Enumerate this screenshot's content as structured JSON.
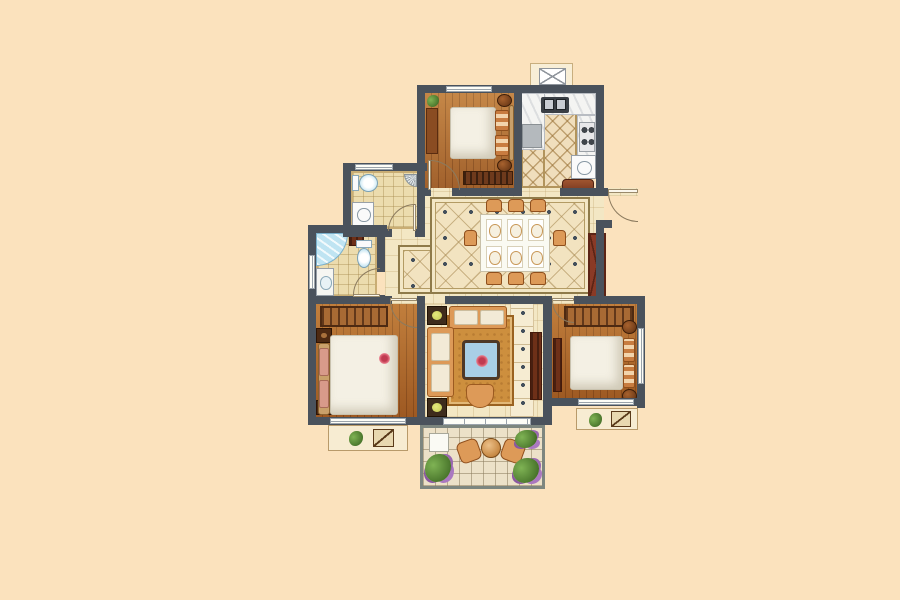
{
  "scene": {
    "type": "residential-floor-plan",
    "view": "top-down-rendered",
    "text_labels": []
  },
  "colors": {
    "bg": "#fbe2bd",
    "wall": "#4a525c",
    "wall_light": "#7d867f",
    "wood": "#b06a2c",
    "wood_light": "#b5753a",
    "tile": "#f3e7c4",
    "dining_tile": "#f2e3c0",
    "kitchen_tile": "#f0debc",
    "bath_tile": "#ecdcae",
    "balcony_tile": "#ece1c8",
    "counter": "#f4f4f2",
    "cabinet_dark": "#6e3018",
    "sideboard": "#7e3b22",
    "upholstery": "#dd9a58",
    "rug": "#cd8f3e",
    "bed": "#f4f0e4",
    "pillow_pink": "#d89a8a",
    "water_blue": "#bfe4f2",
    "fixture_blue": "#a8d8ec",
    "plant": "#4f7c30",
    "lamp": "#cdd25e",
    "glass_blue": "#a9cfe6",
    "flower_red": "#c03a50",
    "arc": "#8b7a5e",
    "window_frame": "#9aa3ab"
  },
  "rooms": [
    {
      "id": "bedroom-top",
      "floor": "wood",
      "furniture": [
        "double-bed",
        "orange-pillows",
        "nightstand-round-2",
        "desk",
        "bench",
        "plant"
      ]
    },
    {
      "id": "kitchen",
      "floor": "diamond-tile",
      "furniture": [
        "l-counter",
        "double-sink",
        "stove-4-burner",
        "fridge",
        "lower-cabinet",
        "sideboard"
      ]
    },
    {
      "id": "vent-shaft",
      "floor": "none",
      "furniture": [
        "x-marked-duct"
      ]
    },
    {
      "id": "bathroom-upper",
      "floor": "square-tile",
      "furniture": [
        "toilet",
        "washing-machine",
        "shower-head"
      ]
    },
    {
      "id": "bathroom-lower",
      "floor": "square-tile",
      "furniture": [
        "corner-shower",
        "toilet",
        "vanity-sink",
        "small-cabinet"
      ]
    },
    {
      "id": "dining-room",
      "floor": "ornate-diamond-tile",
      "furniture": [
        "dining-table-6-settings",
        "chairs-8",
        "sideboard",
        "x-front-cabinet"
      ]
    },
    {
      "id": "entry",
      "floor": "tile",
      "furniture": [
        "entry-door"
      ]
    },
    {
      "id": "master-bedroom",
      "floor": "wood",
      "furniture": [
        "double-bed",
        "pink-pillows",
        "wardrobe",
        "nightstand-square-2",
        "red-flower-deco"
      ]
    },
    {
      "id": "living-room",
      "floor": "tile",
      "furniture": [
        "corner-sofa",
        "chaise",
        "coffee-table-glass",
        "stool",
        "rug",
        "tv-cabinet",
        "lamp-table-2"
      ]
    },
    {
      "id": "bedroom-right",
      "floor": "wood",
      "furniture": [
        "double-bed",
        "orange-pillows",
        "wardrobe",
        "nightstand-round-2",
        "dresser"
      ]
    },
    {
      "id": "balcony",
      "floor": "grid-tile",
      "furniture": [
        "round-table",
        "lounge-chair-2",
        "planter-box",
        "plants"
      ]
    },
    {
      "id": "bay-window-left",
      "floor": "ledge",
      "furniture": [
        "plant",
        "mini-chair"
      ]
    },
    {
      "id": "bay-window-right",
      "floor": "ledge",
      "furniture": [
        "plant",
        "mini-chair"
      ]
    }
  ]
}
